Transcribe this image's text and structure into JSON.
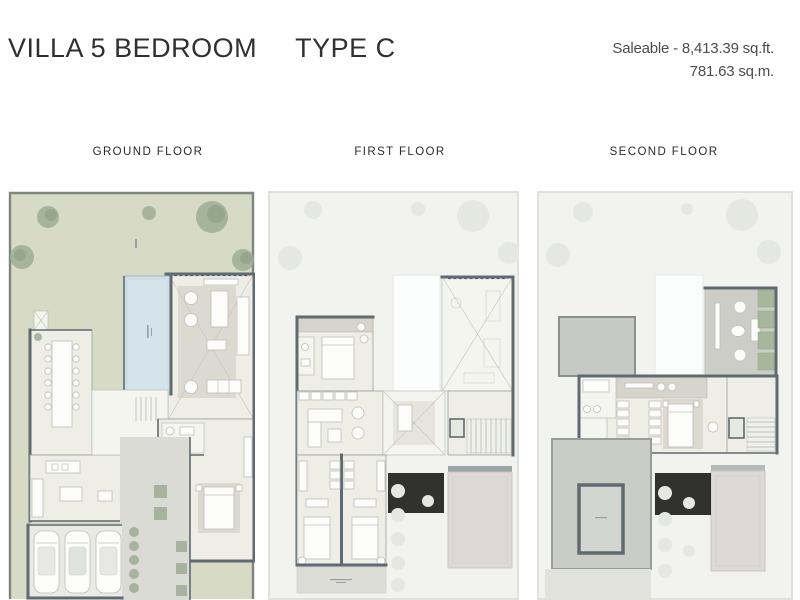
{
  "header": {
    "title": "VILLA 5 BEDROOM",
    "type_label": "TYPE C",
    "saleable_line1": "Saleable - 8,413.39 sq.ft.",
    "saleable_line2": "781.63 sq.m."
  },
  "floors": [
    {
      "id": "ground",
      "label": "GROUND FLOOR"
    },
    {
      "id": "first",
      "label": "FIRST FLOOR"
    },
    {
      "id": "second",
      "label": "SECOND FLOOR"
    }
  ],
  "colors": {
    "garden": "#d7dac5",
    "boundaryc": "#7f867e",
    "tree": "#9dac95",
    "treedark": "#7f9378",
    "ghostbg": "#f2f2ee",
    "ghostline": "#e1e1db",
    "ghosttree": "#e5e7e1",
    "wall": "#5f6a71",
    "room": "#eeede6",
    "room2": "#f5f5f0",
    "band": "#d7d4cc",
    "rug": "#dcd9d0",
    "pool": "#cfdfe8",
    "poolline": "#a4b4bc",
    "court": "#dadbd5",
    "roof": "#c7cac4",
    "roofline": "#8a908b",
    "terracepink": "#ded8d6",
    "planter": "#a7b79b"
  }
}
